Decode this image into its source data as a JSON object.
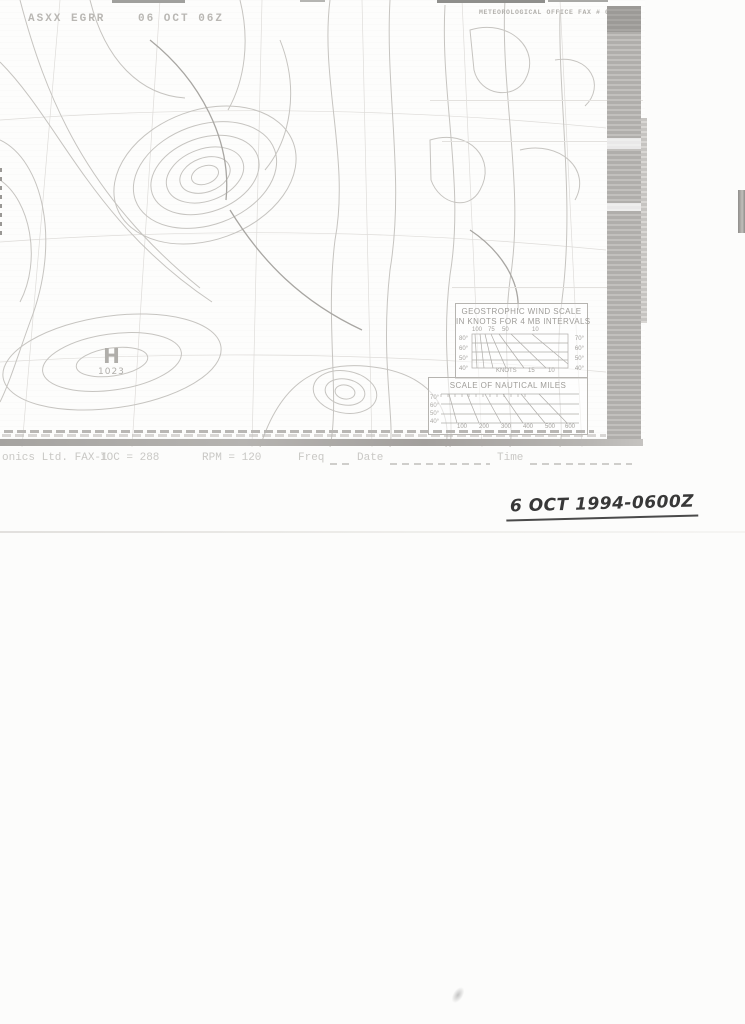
{
  "header": {
    "station_code": "ASXX EGRR",
    "datetime_code": "06 OCT 06Z",
    "office_label": "METEOROLOGICAL OFFICE FAX # 06"
  },
  "map": {
    "high_letter": "H",
    "high_value": "1023"
  },
  "wind_scale": {
    "title_line1": "GEOSTROPHIC WIND SCALE",
    "title_line2": "IN KNOTS FOR 4 MB INTERVALS",
    "top_labels": [
      "100",
      "75",
      "50",
      "10"
    ],
    "bottom_labels": [
      "KNOTS",
      "15",
      "10"
    ],
    "left_labels": [
      "80°",
      "60°",
      "50°",
      "40°"
    ],
    "right_labels": [
      "70°",
      "60°",
      "50°",
      "40°"
    ]
  },
  "nm_scale": {
    "title": "SCALE OF NAUTICAL MILES",
    "bottom_labels": [
      "100",
      "200",
      "300",
      "400",
      "500",
      "600"
    ],
    "left_labels": [
      "70°",
      "60°",
      "50°",
      "40°"
    ]
  },
  "fax_footer": {
    "device_fragment": "onics Ltd. FAX-1",
    "ioc": "IOC = 288",
    "rpm": "RPM = 120",
    "freq_label": "Freq",
    "date_label": "Date",
    "time_label": "Time"
  },
  "annotation": {
    "handwritten_date": "6 OCT 1994-0600Z"
  },
  "colors": {
    "isobar_ink": "#c6c4c0",
    "front_ink": "#a8a6a2",
    "band_gray": "#b0aeab",
    "handwriting_ink": "#383838"
  }
}
